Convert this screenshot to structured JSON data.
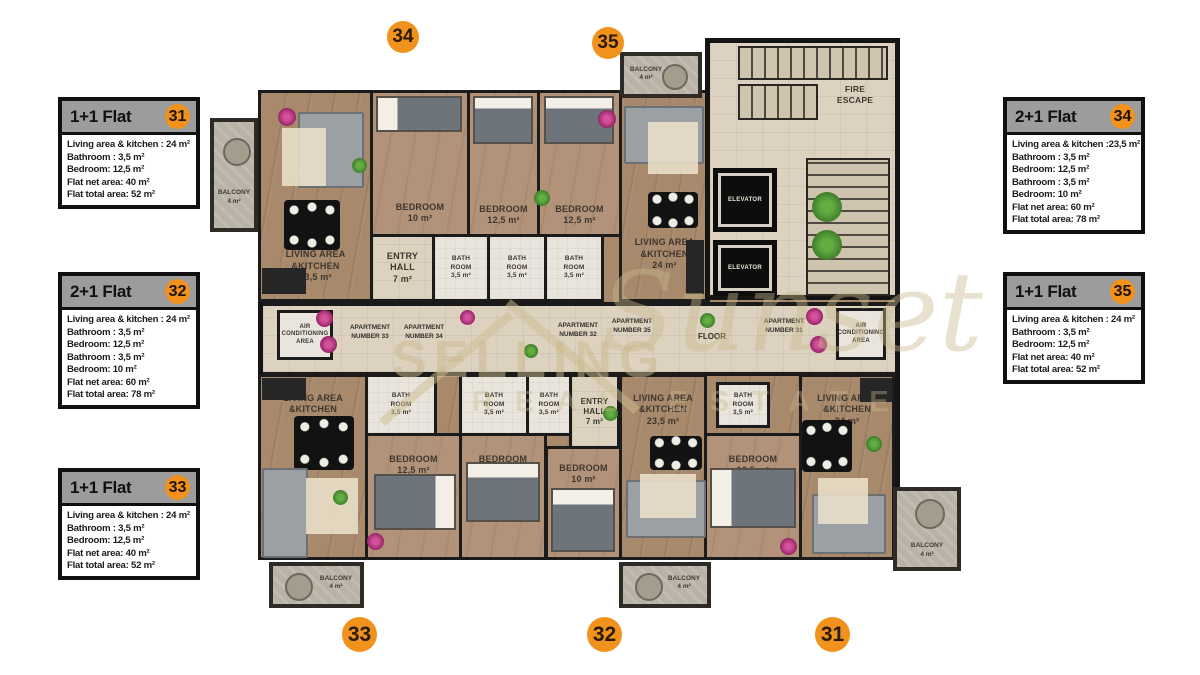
{
  "cards_left": [
    {
      "type": "1+1 Flat",
      "number": "31",
      "lines": [
        "Living area & kitchen : 24 m²",
        "Bathroom : 3,5 m²",
        "Bedroom: 12,5 m²",
        "Flat net area: 40 m²",
        "Flat total area: 52 m²"
      ]
    },
    {
      "type": "2+1 Flat",
      "number": "32",
      "lines": [
        "Living area & kitchen : 24 m²",
        "Bathroom : 3,5 m²",
        "Bedroom: 12,5 m²",
        "Bathroom : 3,5 m²",
        "Bedroom: 10 m²",
        "Flat net area: 60 m²",
        "Flat total area: 78 m²"
      ]
    },
    {
      "type": "1+1 Flat",
      "number": "33",
      "lines": [
        "Living area & kitchen : 24 m²",
        "Bathroom : 3,5 m²",
        "Bedroom: 12,5 m²",
        "Flat net area: 40 m²",
        "Flat total area: 52 m²"
      ]
    }
  ],
  "cards_right": [
    {
      "type": "2+1 Flat",
      "number": "34",
      "lines": [
        "Living area & kitchen :23,5 m²",
        "Bathroom : 3,5 m²",
        "Bedroom: 12,5 m²",
        "Bathroom : 3,5 m²",
        "Bedroom: 10 m²",
        "Flat net area: 60 m²",
        "Flat total area: 78 m²"
      ]
    },
    {
      "type": "1+1 Flat",
      "number": "35",
      "lines": [
        "Living area & kitchen : 24 m²",
        "Bathroom : 3,5 m²",
        "Bedroom: 12,5 m²",
        "Flat net area: 40 m²",
        "Flat total area: 52 m²"
      ]
    }
  ],
  "markers": {
    "top": [
      {
        "label": "34"
      },
      {
        "label": "35"
      }
    ],
    "bottom": [
      {
        "label": "33"
      },
      {
        "label": "32"
      },
      {
        "label": "31"
      }
    ]
  },
  "plan": {
    "balcony_label": "BALCONY\n4 m²",
    "bath_label": "BATH\nROOM\n3,5 m²",
    "elevator_label": "ELEVATOR",
    "ac_label": "AIR\nCONDITIONING\nAREA",
    "fire_escape_label": "FIRE\nESCAPE",
    "floor_label": "FLOOR",
    "apt_door_labels": {
      "a33": "APARTMENT\nNUMBER 33",
      "a34": "APARTMENT\nNUMBER 34",
      "a32": "APARTMENT\nNUMBER 32",
      "a35": "APARTMENT\nNUMBER 35",
      "a31": "APARTMENT\nNUMBER 31"
    },
    "rooms": {
      "a34_living": "LIVING AREA\n&KITCHEN\n23,5 m²",
      "a34_bed10": "BEDROOM\n10 m²",
      "a34_bed125": "BEDROOM\n12,5 m²",
      "a34_entry": "ENTRY\nHALL\n7 m²",
      "a35_bed125": "BEDROOM\n12,5 m²",
      "a35_living": "LIVING AREA\n&KITCHEN\n24 m²",
      "a33_living": "LIVING AREA\n&KITCHEN\n24 m²",
      "a33_bed125": "BEDROOM\n12,5 m²",
      "a32_entry": "ENTRY\nHALL\n7 m²",
      "a32_bed10": "BEDROOM\n10 m²",
      "a32_bed125": "BEDROOM\n12,5 m²",
      "a32_living": "LIVING AREA\n&KITCHEN\n23,5 m²",
      "a31_bed125": "BEDROOM\n12,5 m²",
      "a31_living": "LIVING AREA\n&KITCHEN\n24 m²"
    },
    "watermark": {
      "top": "SELLING",
      "script": "Sunset",
      "bottom": "REAL ESTATE"
    }
  },
  "colors": {
    "accent_orange": "#f0921c",
    "wall": "#141414",
    "wood": "#a8896b",
    "tile": "#dcd2bf",
    "stone": "#b9b2a7",
    "card_header": "#9c9c9c"
  }
}
